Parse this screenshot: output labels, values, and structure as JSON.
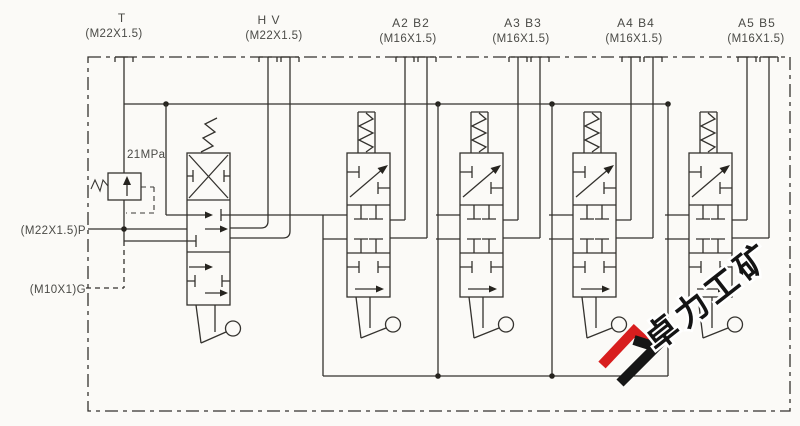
{
  "diagram_type": "hydraulic multi-section directional control valve schematic",
  "top_ports": [
    {
      "name": "T",
      "thread": "(M22X1.5)"
    },
    {
      "name": "H V",
      "thread": "(M22X1.5)"
    },
    {
      "name": "A2 B2",
      "thread": "(M16X1.5)"
    },
    {
      "name": "A3 B3",
      "thread": "(M16X1.5)"
    },
    {
      "name": "A4 B4",
      "thread": "(M16X1.5)"
    },
    {
      "name": "A5 B5",
      "thread": "(M16X1.5)"
    }
  ],
  "side_ports": {
    "p_label": "(M22X1.5)P",
    "g_label": "(M10X1)G"
  },
  "relief_valve": {
    "pressure_setting": "21MPa"
  },
  "watermark": {
    "text": "卓力工矿"
  },
  "colors": {
    "line": "#34322e",
    "logo_red": "#d81e1e",
    "logo_black": "#161616"
  }
}
